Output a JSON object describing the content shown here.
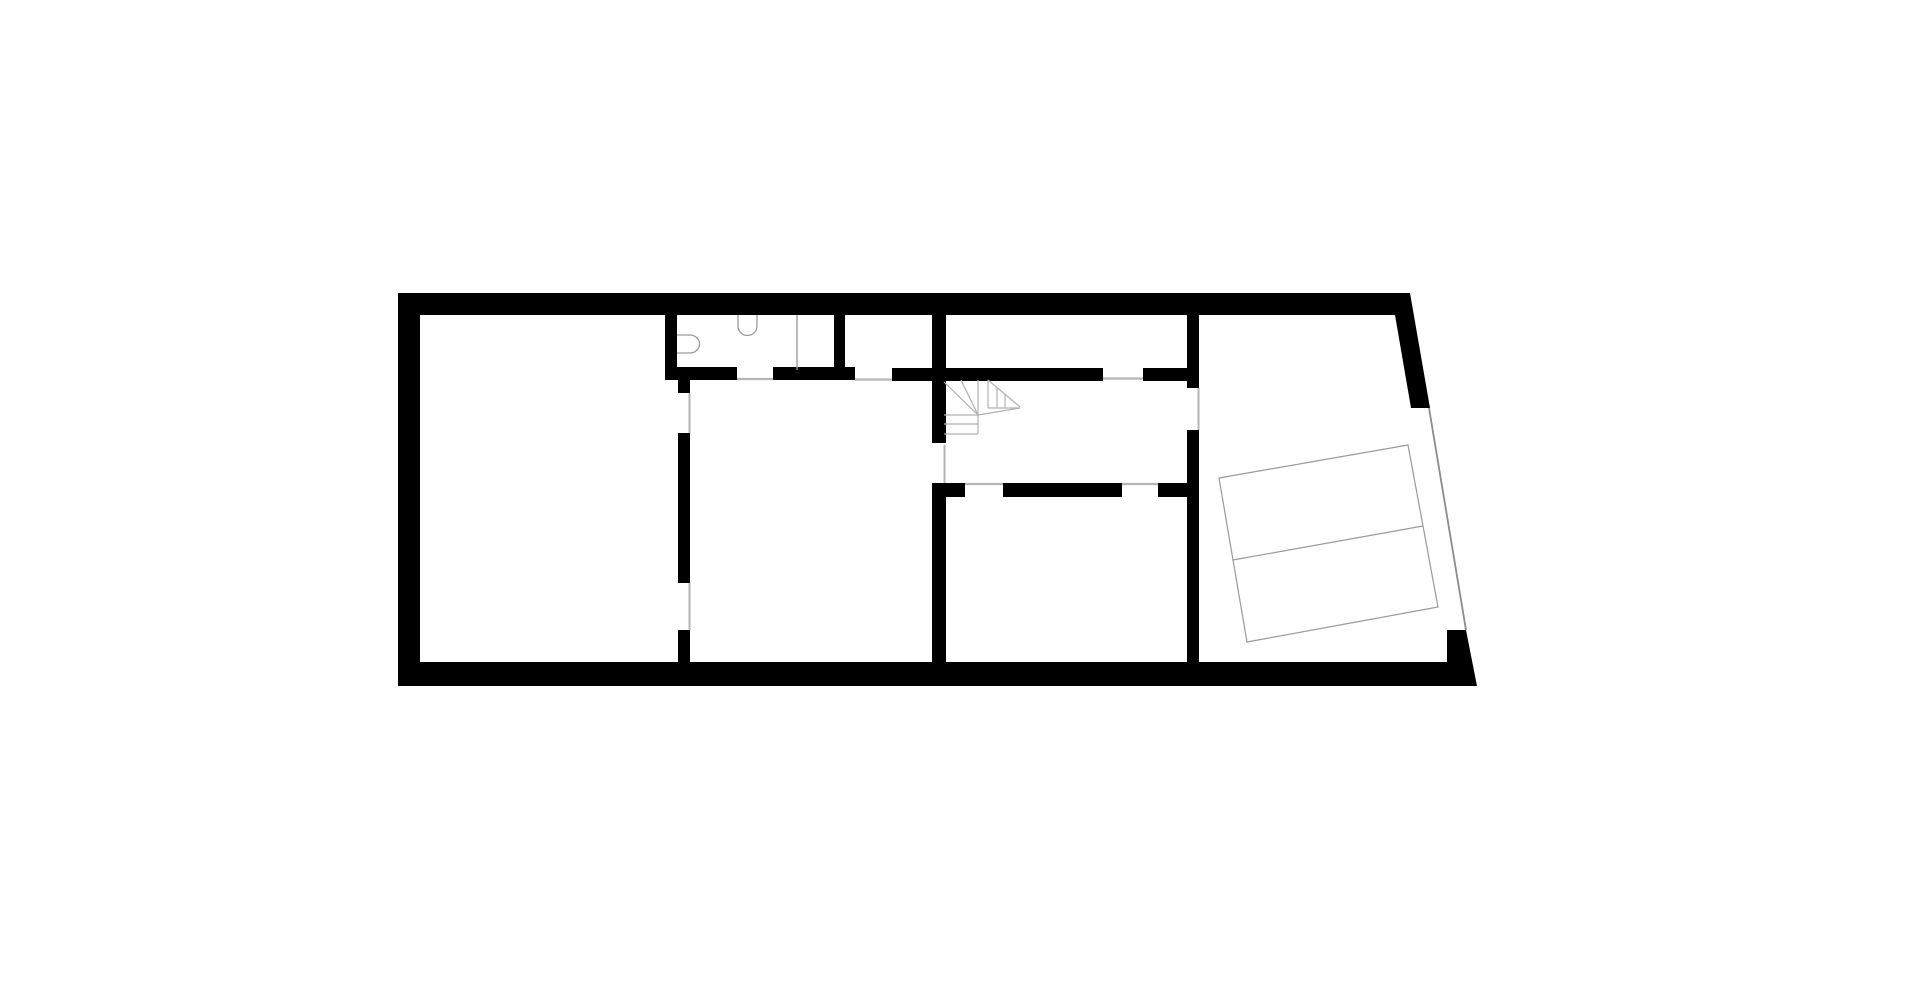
{
  "canvas": {
    "width": 1920,
    "height": 984,
    "background": "#ffffff"
  },
  "colors": {
    "wall": "#000000",
    "opening_line": "#b5b5b5",
    "stair_line": "#b0b0b0",
    "fixture_line": "#9a9a9a",
    "parking_line": "#9a9a9a",
    "garage_line": "#8c8c8c"
  },
  "plan": {
    "wall_rects": [
      {
        "name": "top-exterior-wall",
        "x": 398,
        "y": 293,
        "w": 1012,
        "h": 22
      },
      {
        "name": "left-exterior-wall",
        "x": 398,
        "y": 293,
        "w": 22,
        "h": 393
      },
      {
        "name": "bathroom-left-wall",
        "x": 665,
        "y": 315,
        "w": 12,
        "h": 52
      },
      {
        "name": "corridor-wall-segment-a",
        "x": 665,
        "y": 367,
        "w": 72,
        "h": 13
      },
      {
        "name": "corridor-wall-segment-b",
        "x": 773,
        "y": 367,
        "w": 82,
        "h": 13
      },
      {
        "name": "storage-room-left-wall",
        "x": 834,
        "y": 315,
        "w": 11,
        "h": 53
      },
      {
        "name": "corridor-wall-segment-c",
        "x": 892,
        "y": 368,
        "w": 211,
        "h": 13
      },
      {
        "name": "corridor-wall-segment-d",
        "x": 1143,
        "y": 368,
        "w": 56,
        "h": 13
      },
      {
        "name": "stair-hall-west-wall-upper",
        "x": 932,
        "y": 315,
        "w": 14,
        "h": 128
      },
      {
        "name": "stair-hall-west-wall-lower",
        "x": 932,
        "y": 483,
        "w": 14,
        "h": 179
      },
      {
        "name": "living-room-east-wall-stub",
        "x": 678,
        "y": 380,
        "w": 12,
        "h": 13
      },
      {
        "name": "living-room-east-wall-mid",
        "x": 678,
        "y": 433,
        "w": 12,
        "h": 150
      },
      {
        "name": "living-room-east-wall-bottom",
        "x": 678,
        "y": 630,
        "w": 12,
        "h": 32
      },
      {
        "name": "garage-west-wall-upper",
        "x": 1187,
        "y": 315,
        "w": 12,
        "h": 73
      },
      {
        "name": "garage-west-wall-lower",
        "x": 1187,
        "y": 430,
        "w": 12,
        "h": 232
      },
      {
        "name": "hall-south-wall-stub-left",
        "x": 932,
        "y": 483,
        "w": 33,
        "h": 14
      },
      {
        "name": "hall-south-wall-bar",
        "x": 1003,
        "y": 483,
        "w": 119,
        "h": 14
      },
      {
        "name": "hall-south-wall-stub-right",
        "x": 1158,
        "y": 483,
        "w": 41,
        "h": 14
      }
    ],
    "wall_polygons": [
      {
        "name": "bottom-exterior-wall",
        "points": "398,662 1447,662 1447,630 1466,630 1477,686 398,686"
      },
      {
        "name": "right-slanted-exterior-wall",
        "points": "1410,293 1430,408 1411,408 1395,315"
      }
    ],
    "opening_lines": [
      {
        "name": "bathroom-door-threshold",
        "x1": 737,
        "y1": 379,
        "x2": 773,
        "y2": 379,
        "w": 2.2,
        "color_key": "opening_line"
      },
      {
        "name": "storage-door-threshold",
        "x1": 855,
        "y1": 379.5,
        "x2": 892,
        "y2": 379.5,
        "w": 2.2,
        "color_key": "opening_line"
      },
      {
        "name": "north-room-door-threshold",
        "x1": 1103,
        "y1": 378.5,
        "x2": 1143,
        "y2": 378.5,
        "w": 2.2,
        "color_key": "opening_line"
      },
      {
        "name": "south-room-door-threshold-1",
        "x1": 965,
        "y1": 484,
        "x2": 1003,
        "y2": 484,
        "w": 2.2,
        "color_key": "opening_line"
      },
      {
        "name": "south-room-door-threshold-2",
        "x1": 1122,
        "y1": 484,
        "x2": 1158,
        "y2": 484,
        "w": 2.2,
        "color_key": "opening_line"
      },
      {
        "name": "hall-opening-edge",
        "x1": 944.5,
        "y1": 445,
        "x2": 944.5,
        "y2": 483,
        "w": 2,
        "color_key": "opening_line"
      },
      {
        "name": "garage-door-opening-edge",
        "x1": 1198.5,
        "y1": 388,
        "x2": 1198.5,
        "y2": 430,
        "w": 2,
        "color_key": "opening_line"
      },
      {
        "name": "living-room-door-edge-top",
        "x1": 689.5,
        "y1": 393,
        "x2": 689.5,
        "y2": 433,
        "w": 2,
        "color_key": "opening_line"
      },
      {
        "name": "living-room-door-edge-bottom",
        "x1": 689.5,
        "y1": 583,
        "x2": 689.5,
        "y2": 630,
        "w": 2,
        "color_key": "opening_line"
      },
      {
        "name": "garage-gate-opening-line",
        "x1": 1429,
        "y1": 408,
        "x2": 1466,
        "y2": 630,
        "w": 1.8,
        "color_key": "garage_line"
      },
      {
        "name": "shower-partition-line",
        "x1": 797,
        "y1": 315,
        "x2": 797,
        "y2": 370,
        "w": 1.4,
        "color_key": "fixture_line"
      }
    ],
    "stair_lines": [
      {
        "name": "stair-winder-edge",
        "x1": 944,
        "y1": 382,
        "x2": 978,
        "y2": 415
      },
      {
        "name": "stair-winder-tread-1",
        "x1": 961,
        "y1": 380,
        "x2": 978,
        "y2": 415
      },
      {
        "name": "stair-winder-tread-2",
        "x1": 978,
        "y1": 380,
        "x2": 978,
        "y2": 415
      },
      {
        "name": "stair-flight-top",
        "x1": 944,
        "y1": 415,
        "x2": 978,
        "y2": 415
      },
      {
        "name": "stair-flight-mid",
        "x1": 944,
        "y1": 424,
        "x2": 978,
        "y2": 424
      },
      {
        "name": "stair-flight-bottom",
        "x1": 944,
        "y1": 434,
        "x2": 978,
        "y2": 434
      },
      {
        "name": "stair-flight-right",
        "x1": 978,
        "y1": 415,
        "x2": 978,
        "y2": 434
      },
      {
        "name": "stair-pivot-edge",
        "x1": 978,
        "y1": 415,
        "x2": 1020,
        "y2": 408
      },
      {
        "name": "stair-upper-left",
        "x1": 988,
        "y1": 380,
        "x2": 988,
        "y2": 408
      },
      {
        "name": "stair-upper-hyp",
        "x1": 988,
        "y1": 380,
        "x2": 1020,
        "y2": 407
      },
      {
        "name": "stair-upper-bottom",
        "x1": 988,
        "y1": 408,
        "x2": 1020,
        "y2": 408
      },
      {
        "name": "stair-upper-tread-1",
        "x1": 997,
        "y1": 387.5,
        "x2": 997,
        "y2": 408
      },
      {
        "name": "stair-upper-tread-2",
        "x1": 1005,
        "y1": 394.5,
        "x2": 1005,
        "y2": 408
      }
    ],
    "fixtures": [
      {
        "name": "toilet",
        "path": "M 677 335 L 690 335 A 9.5 9 0 0 1 690 353 L 677 353"
      },
      {
        "name": "sink",
        "path": "M 738 315 L 738 326 A 9.5 9.5 0 0 0 757 326 L 757 315"
      }
    ],
    "parking": {
      "outline_points": "1219,478 1408,445 1438,607 1247,642",
      "divider": {
        "x1": 1233,
        "y1": 560,
        "x2": 1423,
        "y2": 526
      }
    }
  }
}
